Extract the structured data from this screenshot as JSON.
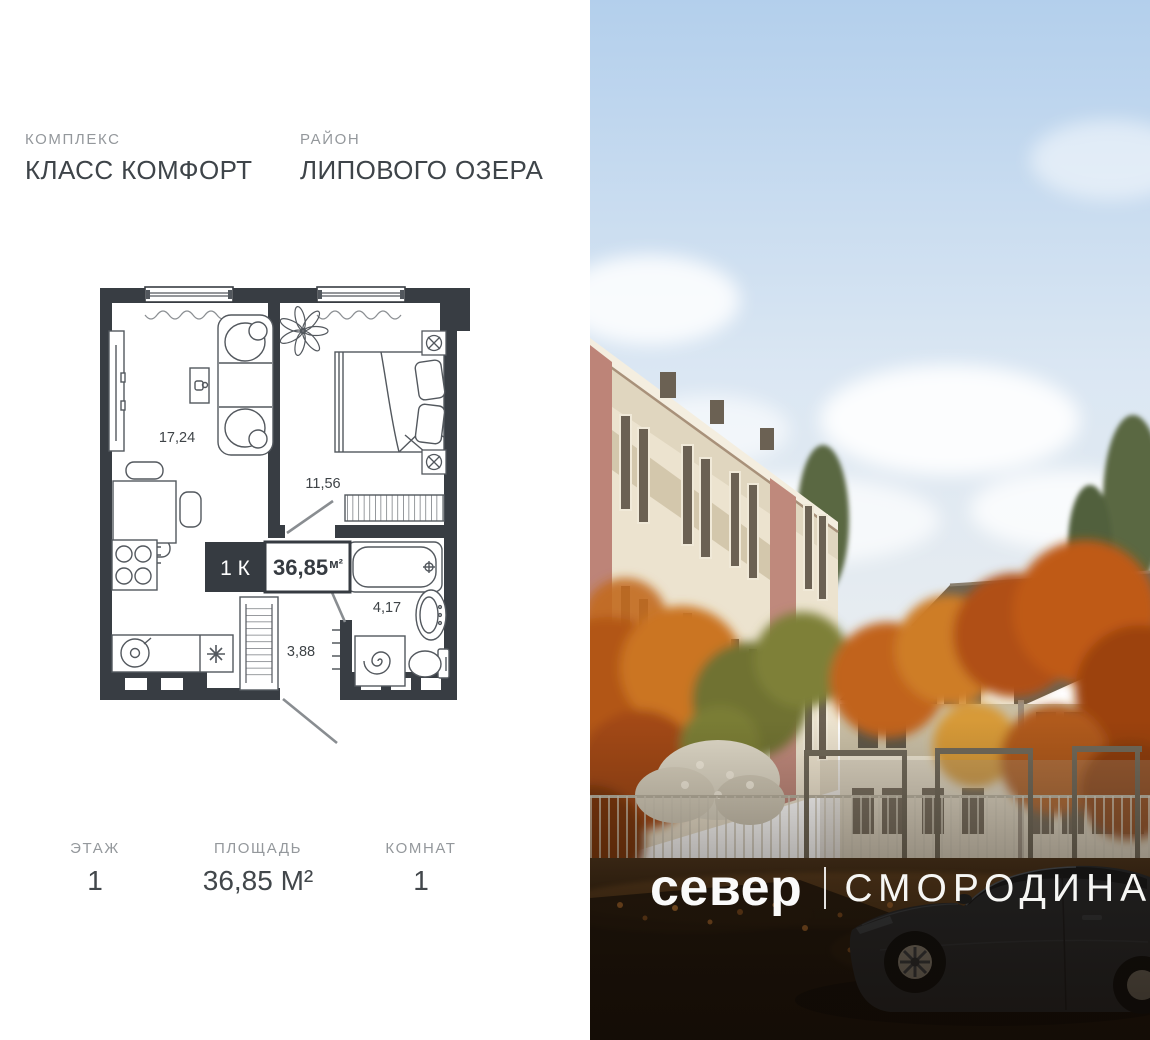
{
  "header": {
    "complex_label": "КОМПЛЕКС",
    "complex_name": "КЛАСС КОМФОРТ",
    "district_label": "РАЙОН",
    "district_name": "ЛИПОВОГО ОЗЕРА"
  },
  "floorplan": {
    "badge": {
      "rooms_short": "1 К",
      "area": "36,85",
      "area_unit": "м²"
    },
    "rooms": {
      "living": "17,24",
      "bedroom": "11,56",
      "bathroom": "4,17",
      "hallway": "3,88"
    }
  },
  "summary": {
    "floor_label": "ЭТАЖ",
    "floor_value": "1",
    "area_label": "ПЛОЩАДЬ",
    "area_value": "36,85 М²",
    "rooms_label": "КОМНАТ",
    "rooms_value": "1"
  },
  "brand": {
    "name": "север",
    "project": "СМОРОДИНА"
  },
  "colors": {
    "wall": "#383d43",
    "text_dark": "#3e4449",
    "text_gray": "#94989c",
    "badge_dark": "#363b41"
  }
}
